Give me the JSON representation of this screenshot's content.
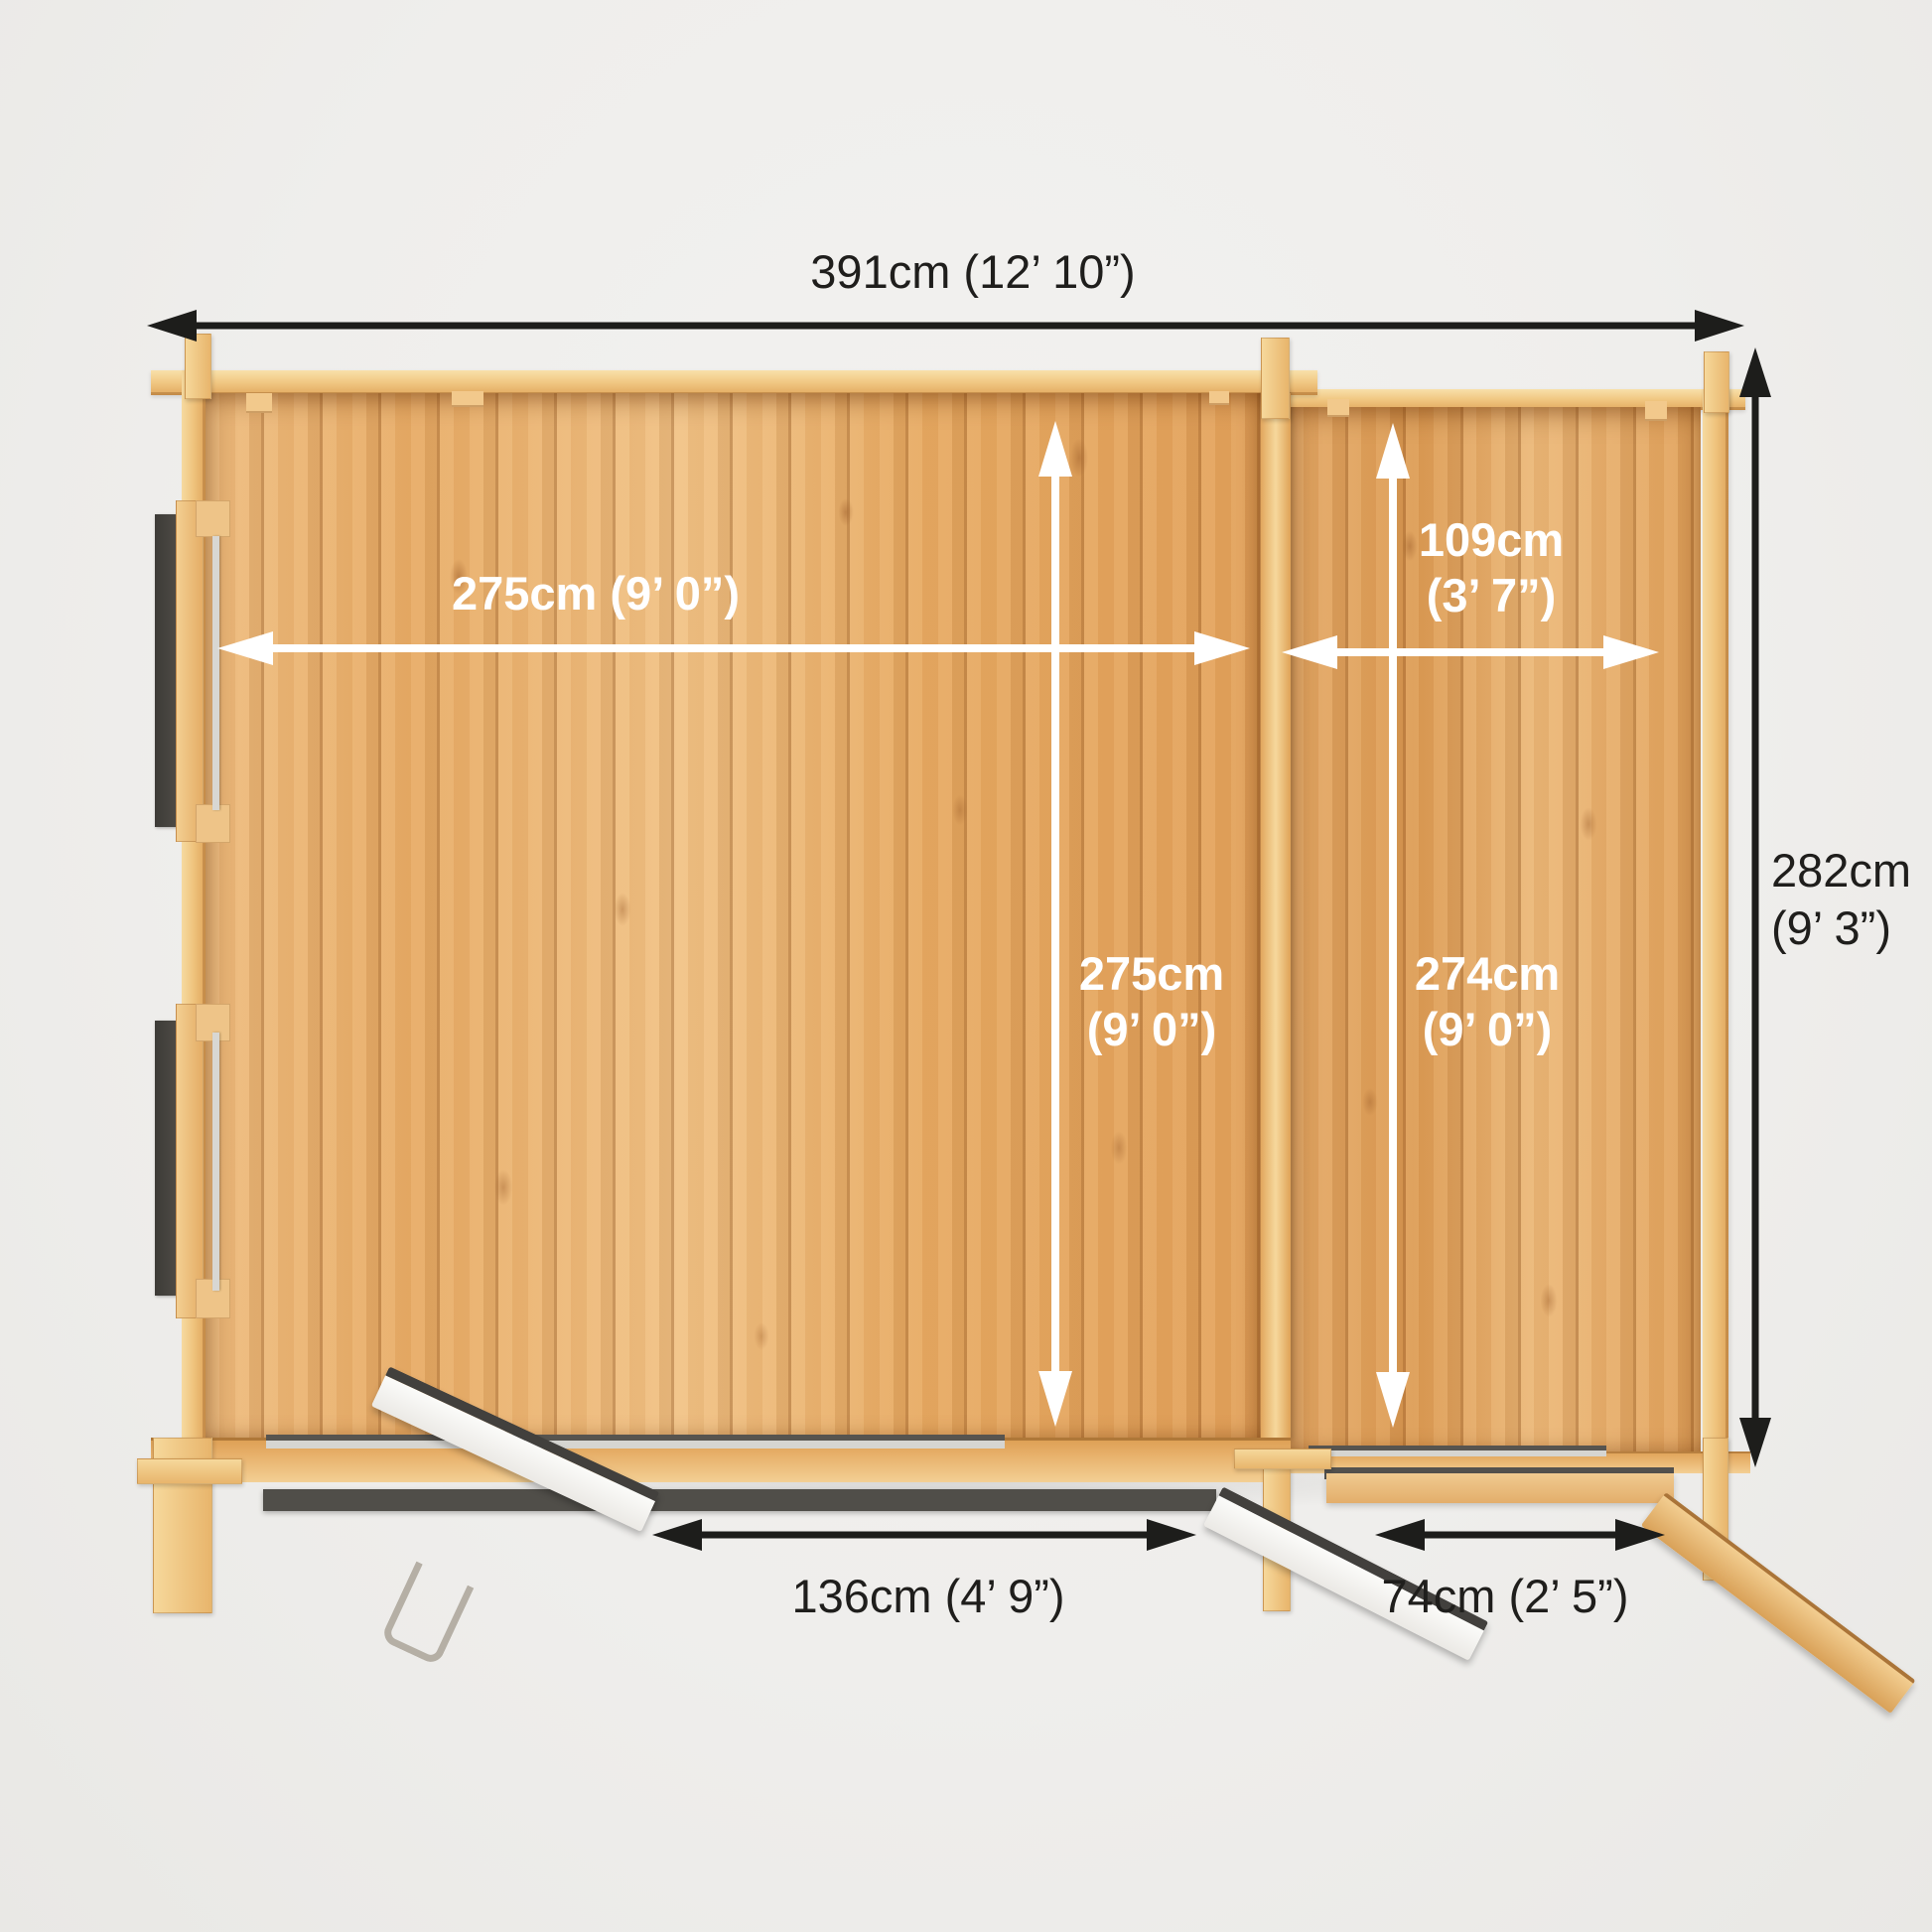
{
  "product_diagram": {
    "view": "top-down floor plan of a log cabin with side annexe",
    "colors": {
      "background": "#f1f0ee",
      "wood_floor": "#eab370",
      "wood_frame": "#f2c988",
      "glazing_dark": "#47453f",
      "dimension_black": "#1f1e1c",
      "dimension_white": "#ffffff"
    },
    "dimensions": {
      "overall_width": "391cm (12’ 10”)",
      "overall_depth": [
        "282cm",
        "(9’ 3”)"
      ],
      "main_room_width": "275cm (9’ 0”)",
      "main_room_depth": [
        "275cm",
        "(9’ 0”)"
      ],
      "annexe_width": [
        "109cm",
        "(3’ 7”)"
      ],
      "annexe_depth": [
        "274cm",
        "(9’ 0”)"
      ],
      "main_door_opening": "136cm (4’ 9”)",
      "annexe_door_opening": "74cm (2’ 5”)"
    }
  }
}
